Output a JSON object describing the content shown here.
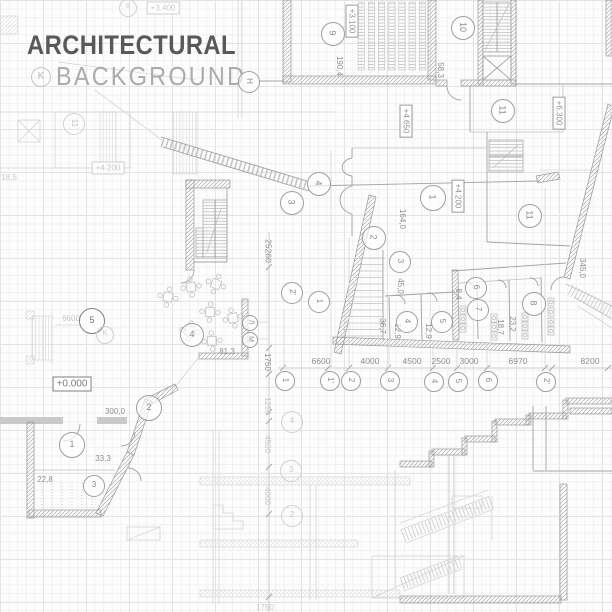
{
  "title": {
    "line1": "ARCHITECTURAL",
    "line2": "BACKGROUND",
    "badge": "K"
  },
  "colors": {
    "title_dark": "#58595b",
    "title_light": "#a9abad",
    "line_medium": "#a2a2a2",
    "line_faint": "#d4d6d7",
    "grid_major": "#e7e2e3",
    "grid_minor": "#f3f0f0"
  },
  "labels": [
    {
      "name": "elevation-3100",
      "text": "+3.100",
      "x": 352,
      "y": 21,
      "rot": 90,
      "boxed": true
    },
    {
      "name": "dim-190-4",
      "text": "190,4",
      "x": 339,
      "y": 66,
      "rot": 90
    },
    {
      "name": "elevation-3400",
      "text": "+3.400",
      "x": 163,
      "y": 8,
      "rot": 0,
      "boxed": true,
      "tone": "faint"
    },
    {
      "name": "dim-58-3",
      "text": "58,3",
      "x": 440,
      "y": 70,
      "rot": 90
    },
    {
      "name": "elevation-6300",
      "text": "+6.300",
      "x": 559,
      "y": 113,
      "rot": 90,
      "boxed": true
    },
    {
      "name": "elevation-4200-faint",
      "text": "+4.200",
      "x": 108,
      "y": 168,
      "rot": 0,
      "boxed": true,
      "tone": "faint"
    },
    {
      "name": "dim-18-5",
      "text": "18,5",
      "x": 9,
      "y": 178,
      "rot": 0,
      "tone": "faint"
    },
    {
      "name": "elevation-4650",
      "text": "+4.650",
      "x": 406,
      "y": 121,
      "rot": 90,
      "boxed": true
    },
    {
      "name": "elevation-4200",
      "text": "+4.200",
      "x": 458,
      "y": 196,
      "rot": 90,
      "boxed": true
    },
    {
      "name": "dim-164-0",
      "text": "164,0",
      "x": 402,
      "y": 219,
      "rot": 90
    },
    {
      "name": "dim-25260",
      "text": "25260",
      "x": 268,
      "y": 251,
      "rot": 90,
      "kind": "dim"
    },
    {
      "name": "dim-45-0",
      "text": "45,0",
      "x": 400,
      "y": 286,
      "rot": 90
    },
    {
      "name": "dim-345-0",
      "text": "345,0",
      "x": 582,
      "y": 268,
      "rot": 90
    },
    {
      "name": "dim-36-7",
      "text": "36,7",
      "x": 382,
      "y": 326,
      "rot": 90
    },
    {
      "name": "dim-12-9-a",
      "text": "12,9",
      "x": 397,
      "y": 331,
      "rot": 90
    },
    {
      "name": "dim-12-9-b",
      "text": "12,9",
      "x": 428,
      "y": 331,
      "rot": 90
    },
    {
      "name": "dim-8-4",
      "text": "8,4",
      "x": 458,
      "y": 294,
      "rot": 90
    },
    {
      "name": "dim-18-7",
      "text": "18,7",
      "x": 500,
      "y": 327,
      "rot": 90
    },
    {
      "name": "dim-23-2",
      "text": "23,2",
      "x": 512,
      "y": 324,
      "rot": 90
    },
    {
      "name": "dim-81-3",
      "text": "81,3",
      "x": 227,
      "y": 352,
      "rot": 0
    },
    {
      "name": "dim-1750",
      "text": "1750",
      "x": 267,
      "y": 362,
      "rot": 90
    },
    {
      "name": "elevation-0000",
      "text": "+0.000",
      "x": 72,
      "y": 384,
      "rot": 0,
      "boxed": true,
      "tone": "dark"
    },
    {
      "name": "dim-6600-faint",
      "text": "6600",
      "x": 71,
      "y": 319,
      "rot": 0,
      "tone": "faint"
    },
    {
      "name": "dim-6600",
      "text": "6600",
      "x": 321,
      "y": 361,
      "rot": 0,
      "kind": "dim"
    },
    {
      "name": "dim-4000",
      "text": "4000",
      "x": 370,
      "y": 361,
      "rot": 0,
      "kind": "dim"
    },
    {
      "name": "dim-4500",
      "text": "4500",
      "x": 412,
      "y": 361,
      "rot": 0,
      "kind": "dim"
    },
    {
      "name": "dim-2500",
      "text": "2500",
      "x": 441,
      "y": 361,
      "rot": 0,
      "kind": "dim"
    },
    {
      "name": "dim-3000",
      "text": "3000",
      "x": 469,
      "y": 361,
      "rot": 0,
      "kind": "dim"
    },
    {
      "name": "dim-6970",
      "text": "6970",
      "x": 518,
      "y": 361,
      "rot": 0,
      "kind": "dim"
    },
    {
      "name": "dim-8200",
      "text": "8200",
      "x": 590,
      "y": 361,
      "rot": 0,
      "kind": "dim"
    },
    {
      "name": "dim-300-0",
      "text": "300,0",
      "x": 115,
      "y": 412,
      "rot": 0
    },
    {
      "name": "dim-33-3",
      "text": "33,3",
      "x": 103,
      "y": 459,
      "rot": 0
    },
    {
      "name": "dim-22-8",
      "text": "22,8",
      "x": 45,
      "y": 480,
      "rot": 0
    },
    {
      "name": "dim-1250-section",
      "text": "1250",
      "x": 267,
      "y": 406,
      "rot": 90,
      "tone": "faint"
    },
    {
      "name": "dim-4500-section",
      "text": "4500",
      "x": 267,
      "y": 444,
      "rot": 90,
      "tone": "faint"
    },
    {
      "name": "dim-4000-section",
      "text": "4000",
      "x": 267,
      "y": 496,
      "rot": 90,
      "tone": "faint"
    },
    {
      "name": "dim-1750-section",
      "text": "1750",
      "x": 265,
      "y": 608,
      "rot": 0,
      "tone": "faint"
    }
  ],
  "bubbles": [
    {
      "name": "bubble-8-top",
      "text": "8",
      "x": 127,
      "y": 7,
      "r": 8,
      "tone": "faint"
    },
    {
      "name": "bubble-9",
      "text": "9",
      "x": 332,
      "y": 33,
      "r": 11,
      "rot": 90
    },
    {
      "name": "bubble-h",
      "text": "H",
      "x": 248,
      "y": 81,
      "r": 10,
      "rot": 90
    },
    {
      "name": "bubble-10",
      "text": "10",
      "x": 462,
      "y": 27,
      "r": 11,
      "rot": 90
    },
    {
      "name": "bubble-11-a",
      "text": "11",
      "x": 502,
      "y": 110,
      "r": 11,
      "rot": 90
    },
    {
      "name": "bubble-11-faint",
      "text": "11",
      "x": 73,
      "y": 123,
      "r": 10,
      "tone": "faint",
      "rot": 90
    },
    {
      "name": "bubble-4-ramp",
      "text": "4",
      "x": 318,
      "y": 183,
      "r": 11,
      "rot": 90
    },
    {
      "name": "bubble-3-ramp",
      "text": "3",
      "x": 291,
      "y": 202,
      "r": 11,
      "rot": 90
    },
    {
      "name": "bubble-1-room",
      "text": "1",
      "x": 432,
      "y": 197,
      "r": 12,
      "rot": 90
    },
    {
      "name": "bubble-2-hall",
      "text": "2",
      "x": 373,
      "y": 237,
      "r": 11,
      "rot": 90
    },
    {
      "name": "bubble-11-b",
      "text": "11",
      "x": 529,
      "y": 215,
      "r": 11,
      "rot": 90
    },
    {
      "name": "bubble-3-stair",
      "text": "3",
      "x": 399,
      "y": 261,
      "r": 10,
      "rot": 90
    },
    {
      "name": "bubble-2p-axis",
      "text": "2'",
      "x": 291,
      "y": 292,
      "r": 10,
      "rot": 90
    },
    {
      "name": "bubble-1-axis-diag",
      "text": "1",
      "x": 318,
      "y": 301,
      "r": 10,
      "rot": 90
    },
    {
      "name": "bubble-4-room",
      "text": "4",
      "x": 406,
      "y": 321,
      "r": 10,
      "rot": 90
    },
    {
      "name": "bubble-5-room",
      "text": "5",
      "x": 441,
      "y": 321,
      "r": 10,
      "rot": 90
    },
    {
      "name": "bubble-6-room",
      "text": "6",
      "x": 475,
      "y": 287,
      "r": 10,
      "rot": 90
    },
    {
      "name": "bubble-7-room",
      "text": "7",
      "x": 477,
      "y": 309,
      "r": 10,
      "rot": 90
    },
    {
      "name": "bubble-8-room",
      "text": "8",
      "x": 533,
      "y": 303,
      "r": 11,
      "rot": 90
    },
    {
      "name": "bubble-5-dark",
      "text": "5",
      "x": 91,
      "y": 320,
      "r": 12,
      "tone": "dark"
    },
    {
      "name": "bubble-k-small",
      "text": "K",
      "x": 104,
      "y": 334,
      "r": 8,
      "tone": "faint"
    },
    {
      "name": "bubble-4-tables",
      "text": "4",
      "x": 191,
      "y": 334,
      "r": 11
    },
    {
      "name": "bubble-l-axis",
      "text": "Л",
      "x": 249,
      "y": 322,
      "r": 7,
      "rot": 90
    },
    {
      "name": "bubble-m-axis",
      "text": "М",
      "x": 249,
      "y": 339,
      "r": 7,
      "rot": 90
    },
    {
      "name": "bubble-2-room",
      "text": "2",
      "x": 148,
      "y": 407,
      "r": 12
    },
    {
      "name": "bubble-1-room-bl",
      "text": "1",
      "x": 71,
      "y": 444,
      "r": 12
    },
    {
      "name": "bubble-3-room-bl",
      "text": "3",
      "x": 93,
      "y": 485,
      "r": 10
    },
    {
      "name": "axis-1",
      "text": "1",
      "x": 284,
      "y": 380,
      "r": 9,
      "rot": 90
    },
    {
      "name": "axis-1p",
      "text": "1'",
      "x": 329,
      "y": 380,
      "r": 9,
      "rot": 90
    },
    {
      "name": "axis-2",
      "text": "2",
      "x": 350,
      "y": 380,
      "r": 9,
      "rot": 90
    },
    {
      "name": "axis-3",
      "text": "3",
      "x": 389,
      "y": 380,
      "r": 9,
      "rot": 90
    },
    {
      "name": "axis-4",
      "text": "4",
      "x": 433,
      "y": 381,
      "r": 9,
      "rot": 90
    },
    {
      "name": "axis-5",
      "text": "5",
      "x": 457,
      "y": 381,
      "r": 9,
      "rot": 90
    },
    {
      "name": "axis-6",
      "text": "6",
      "x": 487,
      "y": 380,
      "r": 9,
      "rot": 90
    },
    {
      "name": "axis-2p",
      "text": "2'",
      "x": 545,
      "y": 381,
      "r": 9,
      "rot": 90
    },
    {
      "name": "section-4",
      "text": "4",
      "x": 291,
      "y": 421,
      "r": 10,
      "tone": "faint"
    },
    {
      "name": "section-3",
      "text": "3",
      "x": 290,
      "y": 470,
      "r": 10,
      "tone": "faint"
    },
    {
      "name": "section-2",
      "text": "2",
      "x": 291,
      "y": 515,
      "r": 10,
      "tone": "faint"
    }
  ]
}
